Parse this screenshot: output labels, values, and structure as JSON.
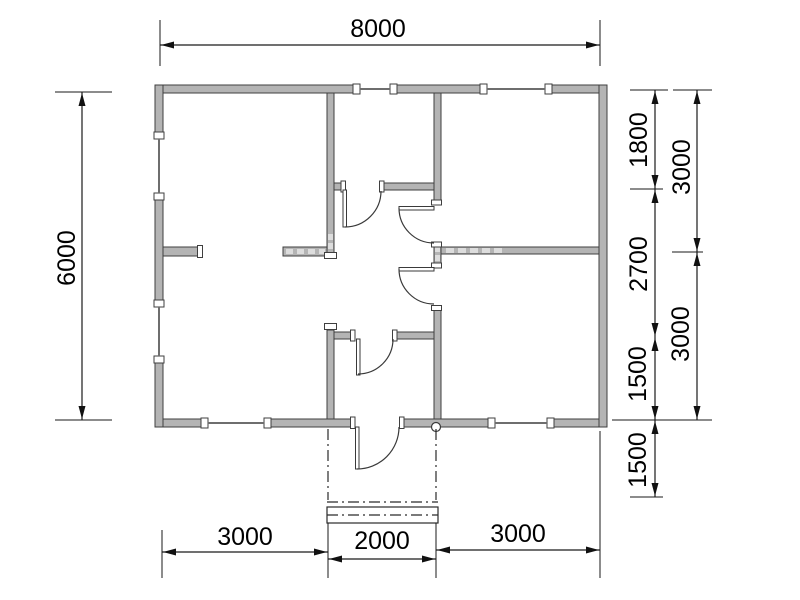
{
  "plan": {
    "type": "floor-plan",
    "units": "mm",
    "building": {
      "width_mm": "8000",
      "depth_mm": "6000"
    },
    "colors": {
      "wall_fill": "#b4b4b4",
      "wall_stroke": "#3f3f3f",
      "dimension_line": "#1a1a1a",
      "background": "#ffffff"
    },
    "dims": {
      "top_total": "8000",
      "left_total": "6000",
      "right_inner_1": "1800",
      "right_inner_2": "2700",
      "right_inner_3": "1500",
      "right_inner_4": "1500",
      "right_outer_1": "3000",
      "right_outer_2": "3000",
      "bottom_1": "3000",
      "bottom_2": "2000",
      "bottom_3": "3000"
    }
  }
}
